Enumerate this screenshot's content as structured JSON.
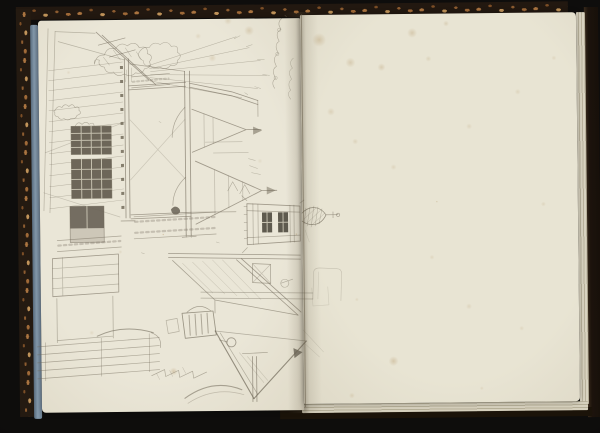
{
  "scene": {
    "description": "Photograph of an open sketchbook: pencil sketch of village houses, a gateway frame and a church tower with spire drawn sideways on the left page with a faint illegible handwritten inscription near the gutter; right page blank with foxing stains; dark marbled covers and blue page edges visible."
  },
  "colors": {
    "background": "#0e0d0c",
    "cover_dark": "#241a11",
    "cover_fleck_light": "#c1945a",
    "cover_fleck_mid": "#8d5c30",
    "page_edge_blue": "#8499ab",
    "paper_left": "#eae6d7",
    "paper_right": "#e8e4d3",
    "pencil": "#6f6858",
    "pencil_dark_fill": "#4d463a",
    "pane_light": "#ded9c7",
    "foxing": "#a8854f",
    "gutter_shadow": "rgba(92,82,62,0.30)"
  },
  "sketch": {
    "pencil_color": "#6f6858",
    "pencil_paths": [
      {
        "d": "M150,78 L98,30 M157,83 L104,33",
        "w": 0.8
      },
      {
        "d": "M100,43 L127,36 M111,55 L137,48",
        "w": 0.6
      },
      {
        "d": "M50,26 L44,208 M57,29 L50,210",
        "o": 0.42
      },
      {
        "d": "M97,31 L57,29 M60,39 L126,58",
        "o": 0.4
      },
      {
        "d": "M46,150 L126,120 M44,190 L120,215",
        "o": 0.28
      },
      {
        "d": "M50,68 L124,60 M50,78 L124,70 M50,88 L124,80 M50,98 L124,90 M50,108 L124,100 M50,119 L124,111 M50,129 L124,121",
        "w": 0.5,
        "o": 0.42
      },
      {
        "d": "M50,140 L124,132 M50,151 L124,143 M50,162 L124,154 M50,173 L124,165 M50,184 L124,176 M50,195 L124,187 M50,206 L124,198",
        "w": 0.5,
        "o": 0.42
      },
      {
        "d": "M126,57 L126,216 M130,57 L130,216",
        "w": 0.9
      },
      {
        "d": "M121,219 L135,219",
        "w": 0.8
      },
      {
        "d": "M72,124 L112,124 L112,152 L72,152 Z M72,157 L112,157 L112,196 L72,196 Z",
        "w": 0.9,
        "o": 0.75
      },
      {
        "d": "M70,204 L104,204 L104,240 L70,240 Z",
        "o": 0.6
      },
      {
        "d": "M56,108 q3,-6 7,-3 q3,-5 7,-1 q4,-4 6,1 q5,-2 4,3 q4,3 -2,5 q-1,4 -6,3 q-3,3 -7,0 q-4,2 -6,-2 q-4,0 -3,-4 q-2,-2 0,-2",
        "o": 0.5,
        "w": 0.55
      },
      {
        "d": "M76,124 q3,-6 7,-2 q4,-4 7,0 q5,-3 5,2 q4,2 0,5 q-2,4 -7,2 q-4,3 -8,-1 q-4,0 -4,-6",
        "o": 0.48,
        "w": 0.55
      },
      {
        "d": "M96,62 q2,-10 10,-9 q3,-9 11,-6 q5,-8 12,-3 q8,-6 12,2 q9,-3 8,6 q7,2 2,8 q3,6 -5,7 q-2,6 -9,4 q-5,5 -11,1 q-7,4 -11,-2 q-8,2 -9,-5 q-7,-1 -5,-7 q-6,-2 -5,4",
        "o": 0.5,
        "w": 0.55
      },
      {
        "d": "M140,52 q4,-8 11,-6 q4,-7 11,-3 q7,-5 11,2 q8,-2 6,6 q6,3 0,8 q1,6 -7,5 q-4,5 -10,2 q-7,3 -10,-2 q-7,1 -7,-5 q-5,-2 -5,-7",
        "o": 0.45,
        "w": 0.55
      },
      {
        "d": "M105,55 l6,8 M115,48 l7,10 M127,46 l6,9 M138,50 l5,8 M128,68 L127,80 M133,66 L133,80",
        "o": 0.4,
        "w": 0.5
      },
      {
        "d": "M150,64 L238,36 M151,67 L251,47 M152,70 L262,60 M152,73 L268,75 M151,76 L259,88 M150,79 L243,97",
        "o": 0.42,
        "w": 0.5
      },
      {
        "d": "M236,38 l6,-3 M248,46 l6,-2 M259,59 l7,0 M264,74 l7,1 M256,86 l6,2",
        "o": 0.4,
        "w": 0.5
      },
      {
        "d": "M186,70 L186,233 M191,70 L191,233",
        "w": 0.9
      },
      {
        "d": "M130,84 L187,81 M130,88 L187,85",
        "w": 0.75
      },
      {
        "d": "M191,82 L233,91 L259,100 M191,86 L233,95 L259,104",
        "w": 0.8
      },
      {
        "d": "M259,100 L259,116 M131,62 L186,70",
        "o": 0.5
      },
      {
        "d": "M186,106 q-13,13 -13,30 M186,176 q-13,12 -13,28",
        "o": 0.5
      },
      {
        "d": "M131,118 L186,178 M131,178 L186,118",
        "o": 0.25
      },
      {
        "d": "M131,213 L191,211 M131,217 L191,215",
        "w": 0.75
      },
      {
        "d": "M191,211 L236,211",
        "o": 0.5
      },
      {
        "d": "M182,236 L196,235 M186,233 L186,236 M191,233 L191,236",
        "w": 0.7
      },
      {
        "d": "M134,80 L170,77",
        "w": 2,
        "o": 0.28,
        "dash": "2,2.5"
      },
      {
        "d": "M133,75 L171,72 M133,86 L171,83",
        "o": 0.5
      },
      {
        "d": "M193,108 L247,129 M193,151 L247,129 M247,129 L262,129",
        "w": 0.8
      },
      {
        "d": "M205,113 L205,146 M214,117 L214,142",
        "o": 0.35
      },
      {
        "d": "M196,160 L262,190 M196,223 L262,190 M262,190 L277,190",
        "w": 0.85
      },
      {
        "d": "M215,169 L215,214 M229,175 L229,207 M243,181 L243,200",
        "o": 0.35
      },
      {
        "d": "M206,141 L243,141 M214,152 L249,152",
        "o": 0.45,
        "w": 0.5
      },
      {
        "d": "M228,190 l5,-9 5,9 M240,193 l5,-9 5,9",
        "o": 0.5,
        "w": 0.55
      },
      {
        "d": "M250,165 l8,3 M252,172 l9,2 M249,158 l7,2",
        "o": 0.4,
        "w": 0.5
      },
      {
        "d": "M247,203 L247,244 M300,206 L300,241 M247,203 L300,206 M247,244 L300,241",
        "w": 0.85
      },
      {
        "d": "M253,203 L253,244 M258,204 L258,243 M290,205 L290,242 M294,205 L294,242",
        "o": 0.45
      },
      {
        "d": "M247,210 L300,212 M247,237 L300,235",
        "o": 0.5
      },
      {
        "d": "M244,206 L247,206 M244,214 L247,214 M244,222 L247,222 M244,230 L247,230 M244,238 L247,238",
        "o": 0.5,
        "w": 0.55
      },
      {
        "d": "M247,200 L242,195 M247,247 L242,252 M300,203 L304,200",
        "o": 0.45
      },
      {
        "d": "M302,213 C310,205 320,206 326,215 C321,226 310,227 302,221",
        "w": 0.7,
        "o": 0.7
      },
      {
        "d": "M306,208 L304,224 M310,207 L307,226 M314,206 L311,227 M318,207 L315,226 M322,209 L319,224",
        "o": 0.5,
        "w": 0.45
      },
      {
        "d": "M304,219 L316,208 M307,223 L321,210 M312,225 L325,213",
        "o": 0.45,
        "w": 0.45
      },
      {
        "d": "M326,215 L338,215 M333,212 L333,218",
        "w": 0.6,
        "o": 0.6
      },
      {
        "d": "M338,213.5 a1.7,1.7 0 1 0 0.1,0",
        "o": 0.6,
        "w": 0.6
      },
      {
        "d": "M168,252 L300,255 M168,256 L300,259",
        "w": 0.7
      },
      {
        "d": "M236,259 L297,315 M241,258 L300,312",
        "w": 0.8
      },
      {
        "d": "M172,259 L214,299 M214,299 L297,315 M214,299 L214,312",
        "o": 0.55
      },
      {
        "d": "M182,262 L212,292 M192,261 L224,293 M202,260 L236,295 M212,259 L248,297 M222,259 L260,299",
        "o": 0.25,
        "w": 0.5
      },
      {
        "d": "M200,291 L312,293 M200,297 L312,299",
        "o": 0.45
      },
      {
        "d": "M252,263 L270,264 L270,283 L252,282 Z",
        "o": 0.55
      },
      {
        "d": "M252,263 L270,283 M270,264 L252,282",
        "o": 0.3
      },
      {
        "d": "M284,279 a4,4 0 1 0 0.1,0 M280,283 L292,279",
        "o": 0.45,
        "w": 0.6
      },
      {
        "d": "M214,330 L252,398",
        "w": 1.1,
        "o": 0.7
      },
      {
        "d": "M305,341 L252,398",
        "w": 1.1,
        "o": 0.7
      },
      {
        "d": "M219,332 L256,394 M214,330 L305,341",
        "o": 0.45
      },
      {
        "d": "M230,337 a4.5,4.5 0 1 0 0.1,0",
        "w": 0.9,
        "o": 0.6
      },
      {
        "d": "M226,341 L218,339",
        "o": 0.5
      },
      {
        "d": "M251,356 L251,401 M255,356 L255,401",
        "w": 0.85
      },
      {
        "d": "M241,353 L266,352",
        "o": 0.55
      },
      {
        "d": "M238,352 L262,382 M246,356 L266,380",
        "o": 0.22
      },
      {
        "d": "M150,374 l13,-6 l1,7 l13,-6 l1,7 l13,-6 l1,7 l13,-6",
        "o": 0.5,
        "w": 0.65
      },
      {
        "d": "M155,372 l3,6 M168,369 l3,6 M181,366 l3,6",
        "o": 0.32,
        "w": 0.5
      },
      {
        "d": "M183,397 Q211,377 240,389",
        "w": 1.05,
        "o": 0.55
      },
      {
        "d": "M186,402 Q213,385 242,394",
        "o": 0.32
      },
      {
        "d": "M135,220 L215,216 M135,231 L215,227",
        "w": 2.2,
        "o": 0.3,
        "dash": "2.5,3"
      },
      {
        "d": "M134,215 L216,211 M134,237 L216,233",
        "o": 0.5
      },
      {
        "d": "M58,243 L120,239",
        "w": 2.2,
        "o": 0.3,
        "dash": "2.5,3"
      },
      {
        "d": "M57,238 L121,234 M57,249 L121,245",
        "o": 0.5
      },
      {
        "d": "M52,256 L118,252 L118,290 L52,294 Z",
        "w": 0.8,
        "o": 0.6
      },
      {
        "d": "M52,266 L118,262 M52,276 L118,272 M52,286 L118,282 M62,255 L62,293",
        "o": 0.4
      },
      {
        "d": "M56,296 L56,340 M112,294 L112,336 M56,338 L112,334",
        "o": 0.48
      },
      {
        "d": "M36,344 L158,336 M36,352 L158,344 M36,360 L158,352 M36,368 L158,360 M36,376 L158,368",
        "o": 0.5
      },
      {
        "d": "M44,340 L44,378 M100,336 L100,374 M148,332 L148,370",
        "o": 0.42
      },
      {
        "d": "M96,334 Q122,322 152,331",
        "w": 1,
        "o": 0.58
      },
      {
        "d": "M150,331 q11,4 9,15",
        "o": 0.52
      },
      {
        "d": "M181,312 L212,310 L215,334 L184,337 Z",
        "w": 0.85,
        "o": 0.65
      },
      {
        "d": "M186,311 Q198,300 210,310",
        "o": 0.55
      },
      {
        "d": "M188,314 L189,334 M194,313 L195,334 M200,313 L201,333 M206,312 L207,332",
        "w": 1,
        "o": 0.5
      },
      {
        "d": "M165,319 l11,-2 l2,13 l-11,2 Z",
        "o": 0.42
      },
      {
        "d": "M312,299 L313,273 Q313,268 319,268 L336,269 Q341,269 341,274 L340,301",
        "o": 0.28,
        "w": 0.6
      },
      {
        "d": "M317,299 L318,272 M311,288 L312,306 L328,305 L327,287",
        "o": 0.2,
        "w": 0.55
      },
      {
        "d": "M302,330 L322,352 M304,344 L318,357 M305,230 L309,242",
        "o": 0.2,
        "w": 0.55
      },
      {
        "d": "M160,120 l2,1 M216,241 l3,1 M141,251 l3,1 M246,92 l3,2",
        "o": 0.4,
        "w": 0.5
      }
    ],
    "dark_fills": [
      {
        "d": "M72,124 h40 v28 h-40 Z",
        "f": "#4d463a",
        "o": 0.8
      },
      {
        "d": "M72,157 h40 v39 h-40 Z",
        "f": "#4d463a",
        "o": 0.8
      },
      {
        "d": "M70,204 h34 v22 h-34 Z",
        "f": "#473f33",
        "o": 0.72
      },
      {
        "d": "M70,226 h34 v14 h-34 Z",
        "f": "#8b8270",
        "o": 0.3
      },
      {
        "d": "M262,212 h10 v20 h-10 Z",
        "f": "#403a2f",
        "o": 0.82
      },
      {
        "d": "M278,212 h10 v20 h-10 Z",
        "f": "#403a2f",
        "o": 0.82
      },
      {
        "d": "M121.5,64 h3 v3 h-3 Z M121.5,78 h3 v3 h-3 Z M121.5,92 h3 v3 h-3 Z M121.5,106 h3 v3 h-3 Z M121.5,120 h3 v3 h-3 Z M121.5,134 h3 v3 h-3 Z M121.5,148 h3 v3 h-3 Z M121.5,162 h3 v3 h-3 Z M121.5,176 h3 v3 h-3 Z M121.5,190 h3 v3 h-3 Z M121.5,204 h3 v3 h-3 Z",
        "f": "#5a5140",
        "o": 0.7
      },
      {
        "d": "M254,126 L263,130 L254,134 Z",
        "f": "#6f6858",
        "o": 0.55
      },
      {
        "d": "M267,186 L276,190 L267,194 Z",
        "f": "#6f6858",
        "o": 0.5
      },
      {
        "d": "M171,208 q4,-5 8,-1 q3,4 -2,6 q-5,1 -6,-5 Z",
        "f": "#4d463a",
        "o": 0.7
      },
      {
        "d": "M292,348 L301,352 L293,358 Z",
        "f": "#4d463a",
        "o": 0.65
      }
    ],
    "light_paths": [
      {
        "d": "M82,124 L82,152 M92,124 L92,152 M102,124 L102,152 M72,131 L112,131 M72,138 L112,138 M72,145 L112,145"
      },
      {
        "d": "M82,157 L82,196 M92,157 L92,196 M102,157 L102,196 M72,167 L112,167 M72,177 L112,177 M72,187 L112,187"
      },
      {
        "d": "M87,204 L87,226"
      },
      {
        "d": "M267,212 L267,232 M283,212 L283,232 M262,222 L272,222 M278,222 L288,222"
      }
    ],
    "inscription_paths": [
      {
        "d": "M284,18 c-5,4 -3,8 -1,11 c-6,3 -4,8 -2,12 c-5,3 -3,8 -1,12 c-6,4 -4,9 -2,13 c-5,3 -3,8 -1,12 c-4,3 -3,7 -1,10",
        "o": 0.5,
        "w": 0.55
      },
      {
        "d": "M281,28 a1.6,1.6 0 1 0 0.1,0 M279,52 a1.6,1.6 0 1 0 0.1,0 M277,76 a1.6,1.6 0 1 0 0.1,0",
        "o": 0.4,
        "w": 0.5
      },
      {
        "d": "M295,58 c-4,3 -3,7 -1,10 c-5,3 -3,7 -1,11 c-4,3 -3,8 -1,11 c-4,3 -2,7 0,9",
        "o": 0.4,
        "w": 0.5
      },
      {
        "d": "M287,15 l1.5,1.5",
        "o": 0.5,
        "w": 0.7
      }
    ]
  },
  "foxing_spots": [
    [
      321,
      40,
      7,
      0.3
    ],
    [
      352,
      63,
      5,
      0.26
    ],
    [
      383,
      68,
      4,
      0.25
    ],
    [
      414,
      34,
      5,
      0.28
    ],
    [
      448,
      25,
      3,
      0.22
    ],
    [
      430,
      60,
      3,
      0.18
    ],
    [
      332,
      112,
      4,
      0.2
    ],
    [
      356,
      142,
      3,
      0.18
    ],
    [
      394,
      168,
      3,
      0.16
    ],
    [
      470,
      128,
      3,
      0.16
    ],
    [
      519,
      94,
      3,
      0.16
    ],
    [
      543,
      206,
      2.5,
      0.16
    ],
    [
      431,
      258,
      2.5,
      0.15
    ],
    [
      468,
      308,
      3,
      0.16
    ],
    [
      392,
      362,
      5,
      0.3
    ],
    [
      356,
      300,
      2,
      0.15
    ],
    [
      520,
      330,
      2.5,
      0.14
    ],
    [
      480,
      390,
      2,
      0.14
    ],
    [
      350,
      396,
      3,
      0.18
    ],
    [
      555,
      60,
      2.5,
      0.15
    ],
    [
      251,
      30,
      5,
      0.25
    ],
    [
      214,
      57,
      4,
      0.2
    ],
    [
      172,
      370,
      4,
      0.3
    ],
    [
      120,
      250,
      2,
      0.15
    ],
    [
      90,
      330,
      2.5,
      0.14
    ],
    [
      70,
      70,
      2,
      0.14
    ],
    [
      260,
      160,
      2.5,
      0.12
    ],
    [
      230,
      20,
      4,
      0.2
    ],
    [
      200,
      35,
      3,
      0.16
    ],
    [
      296,
      234,
      1.3,
      0.55
    ],
    [
      163,
      233,
      1.3,
      0.5
    ],
    [
      437,
      203,
      1,
      0.4
    ]
  ]
}
